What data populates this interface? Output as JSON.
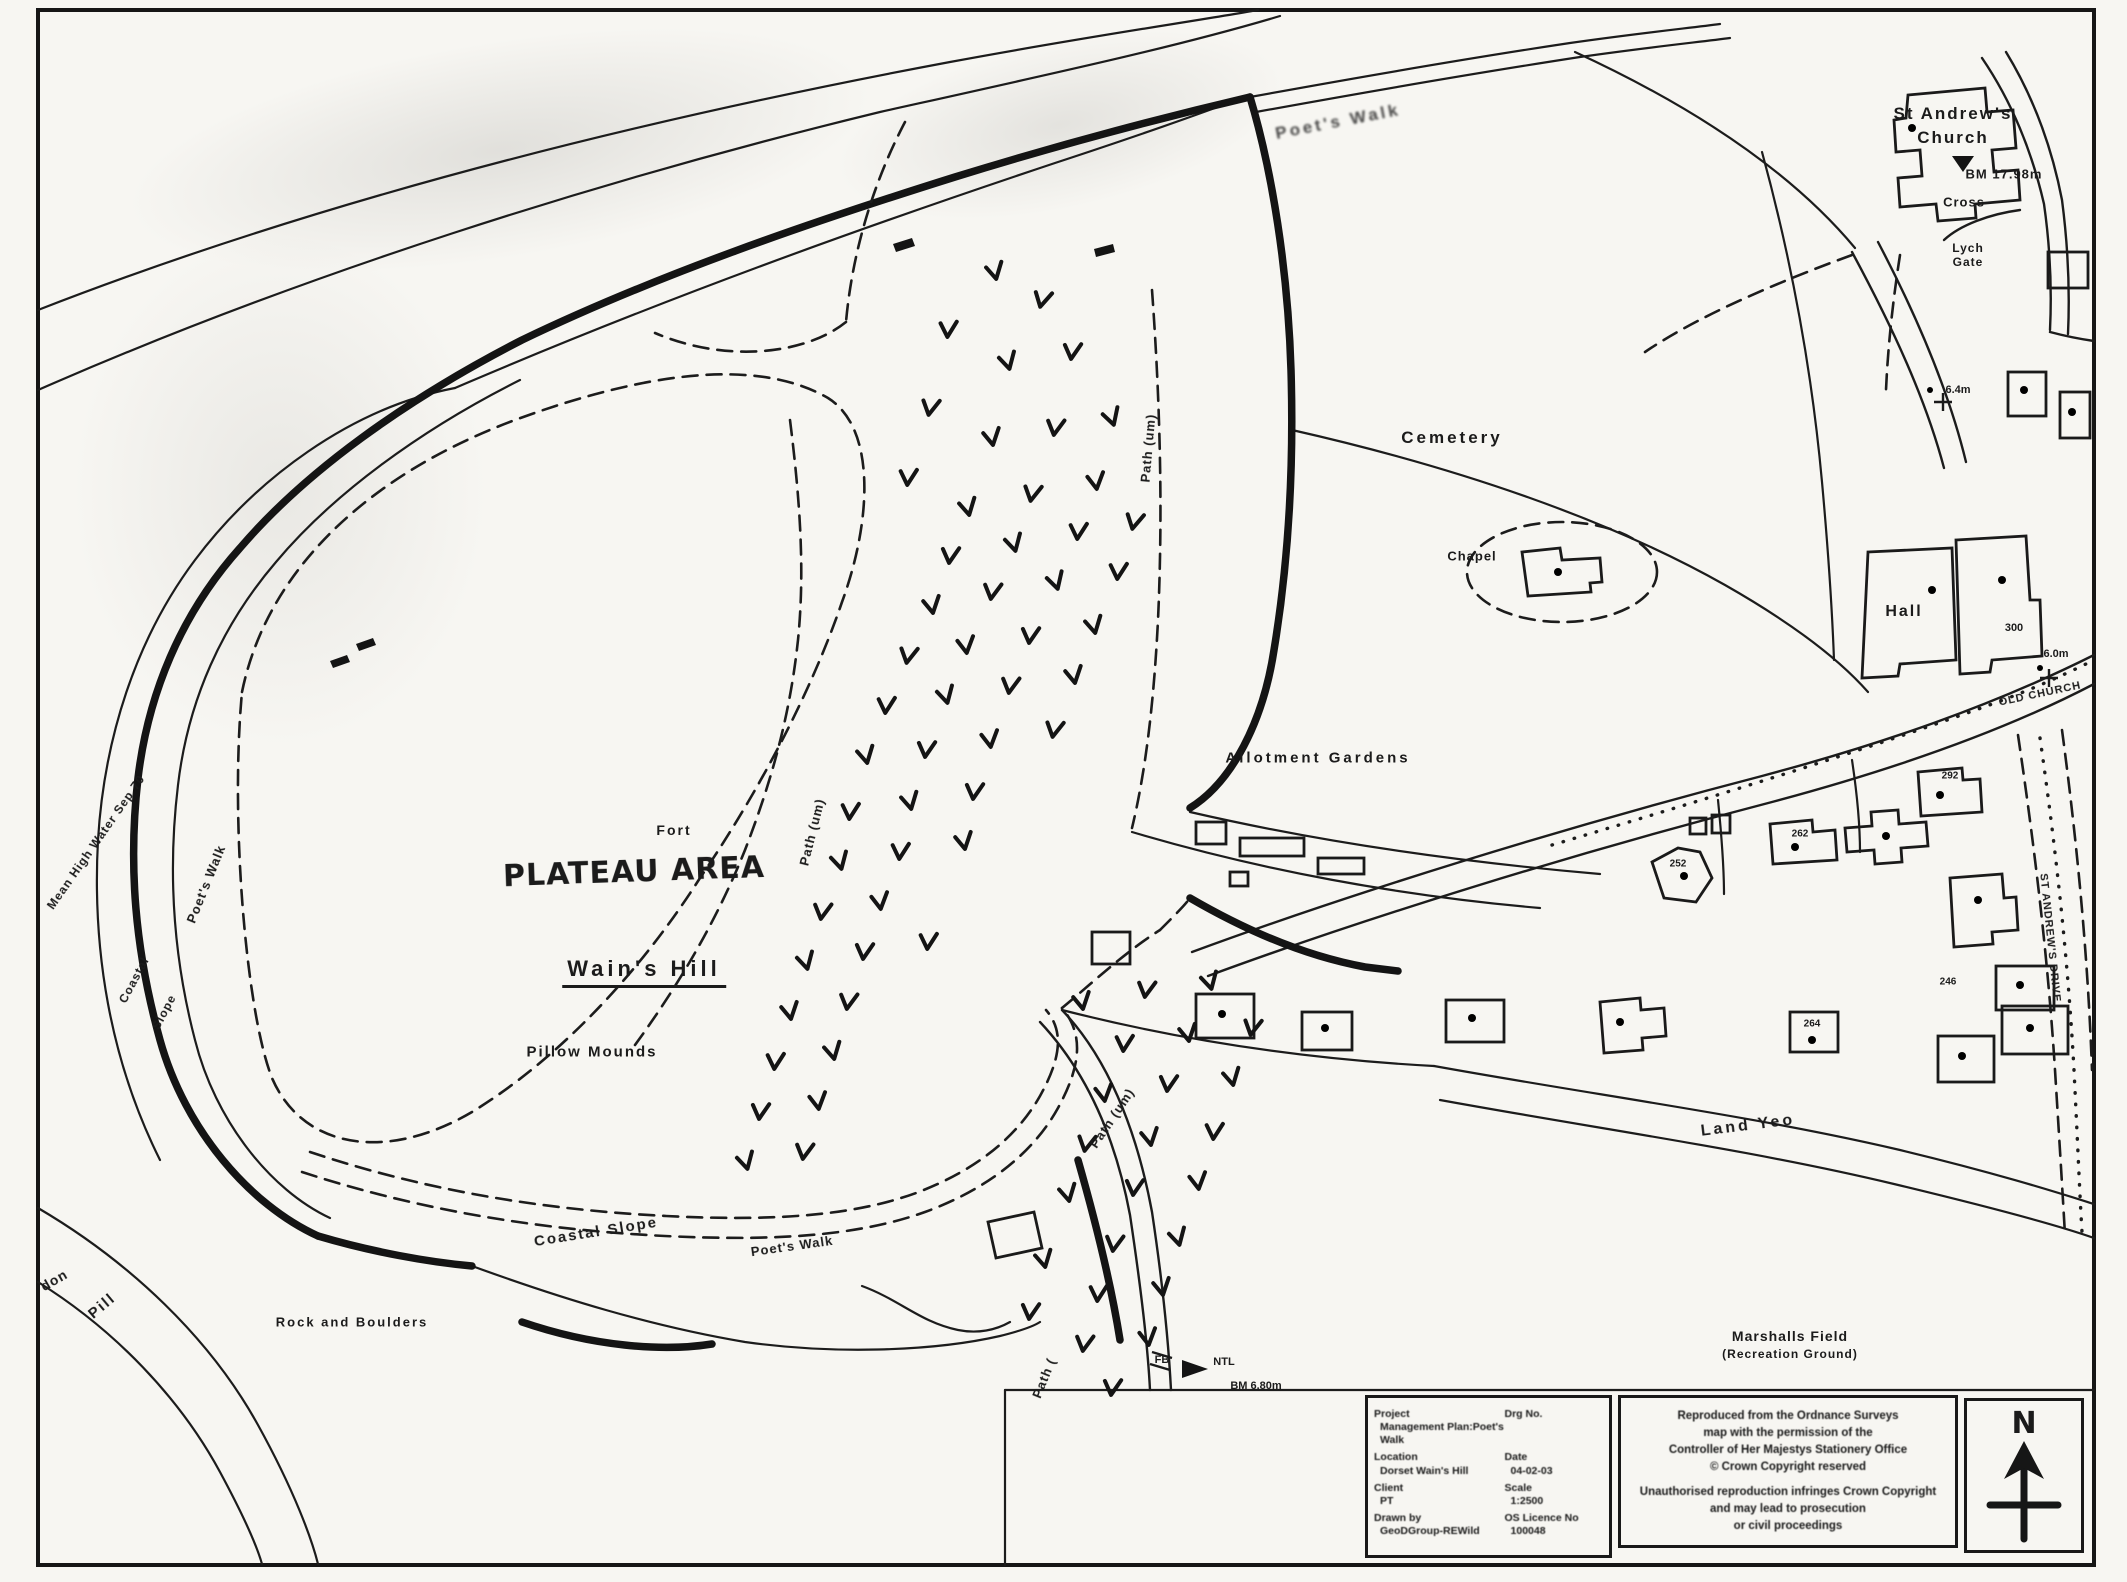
{
  "map": {
    "labels": [
      [
        "Poet's Walk",
        1338,
        122,
        -11,
        17,
        3,
        "s"
      ],
      [
        "St Andrew's",
        1953,
        114,
        0,
        17,
        2,
        "p"
      ],
      [
        "Church",
        1953,
        138,
        0,
        17,
        2,
        "p"
      ],
      [
        "BM 17.98m",
        2004,
        174,
        0,
        13,
        1,
        "p"
      ],
      [
        "Cross",
        1964,
        202,
        0,
        13,
        1,
        "p"
      ],
      [
        "Lych",
        1968,
        248,
        0,
        12,
        1,
        "p"
      ],
      [
        "Gate",
        1968,
        262,
        0,
        12,
        1,
        "p"
      ],
      [
        "Cemetery",
        1452,
        438,
        0,
        17,
        3,
        "p"
      ],
      [
        "Chapel",
        1472,
        556,
        0,
        13,
        1,
        "p"
      ],
      [
        "Hall",
        1904,
        612,
        0,
        16,
        2,
        "p"
      ],
      [
        "300",
        2014,
        628,
        0,
        11,
        0,
        "p"
      ],
      [
        "6.4m",
        1958,
        390,
        0,
        11,
        0,
        "p"
      ],
      [
        "6.0m",
        2056,
        654,
        0,
        11,
        0,
        "p"
      ],
      [
        "OLD CHURCH",
        2040,
        694,
        -12,
        11,
        1,
        "p"
      ],
      [
        "ST ANDREW'S DRIVE",
        2050,
        938,
        84,
        11,
        1,
        "p"
      ],
      [
        "Allotment Gardens",
        1318,
        758,
        0,
        15,
        3,
        "p"
      ],
      [
        "Fort",
        674,
        830,
        0,
        14,
        2,
        "p"
      ],
      [
        "PLATEAU AREA",
        634,
        872,
        -2,
        30,
        1,
        "h"
      ],
      [
        "Wain's Hill",
        644,
        972,
        0,
        22,
        4,
        "u"
      ],
      [
        "Pillow Mounds",
        592,
        1052,
        0,
        15,
        2,
        "p"
      ],
      [
        "Path (um)",
        812,
        832,
        -76,
        13,
        1,
        "p"
      ],
      [
        "Path (um)",
        1148,
        448,
        -85,
        13,
        1,
        "p"
      ],
      [
        "Path (um)",
        1112,
        1118,
        -56,
        13,
        1,
        "p"
      ],
      [
        "Path (",
        1044,
        1378,
        -68,
        13,
        1,
        "p"
      ],
      [
        "Poet's Walk",
        206,
        884,
        -68,
        13,
        1,
        "p"
      ],
      [
        "Mean High Water Sep 70",
        96,
        842,
        -55,
        12,
        1,
        "p"
      ],
      [
        "Coastal",
        134,
        980,
        -62,
        12,
        1,
        "p"
      ],
      [
        "Slope",
        164,
        1012,
        -62,
        12,
        1,
        "p"
      ],
      [
        "Coastal Slope",
        596,
        1232,
        -9,
        15,
        2,
        "p"
      ],
      [
        "Poet's Walk",
        792,
        1246,
        -8,
        13,
        1,
        "p"
      ],
      [
        "Rock and Boulders",
        352,
        1322,
        0,
        13,
        2,
        "p"
      ],
      [
        "don",
        54,
        1280,
        -30,
        14,
        1,
        "p"
      ],
      [
        "Pill",
        102,
        1306,
        -40,
        15,
        2,
        "p"
      ],
      [
        "Land Yeo",
        1748,
        1126,
        -7,
        16,
        3,
        "p"
      ],
      [
        "Marshalls Field",
        1790,
        1336,
        0,
        14,
        1,
        "p"
      ],
      [
        "(Recreation Ground)",
        1790,
        1354,
        0,
        12,
        1,
        "p"
      ],
      [
        "FB",
        1162,
        1360,
        0,
        11,
        0,
        "p"
      ],
      [
        "NTL",
        1224,
        1362,
        0,
        11,
        0,
        "p"
      ],
      [
        "BM 6.80m",
        1256,
        1386,
        0,
        11,
        0,
        "p"
      ],
      [
        "292",
        1950,
        776,
        0,
        10,
        0,
        "p"
      ],
      [
        "262",
        1800,
        834,
        0,
        10,
        0,
        "p"
      ],
      [
        "252",
        1678,
        864,
        0,
        10,
        0,
        "p"
      ],
      [
        "264",
        1812,
        1024,
        0,
        10,
        0,
        "p"
      ],
      [
        "246",
        1948,
        982,
        0,
        10,
        0,
        "p"
      ]
    ],
    "scrub_marks": [
      [
        995,
        272,
        -10
      ],
      [
        1042,
        300,
        15
      ],
      [
        948,
        330,
        5
      ],
      [
        1008,
        362,
        -12
      ],
      [
        1072,
        352,
        8
      ],
      [
        930,
        408,
        12
      ],
      [
        992,
        438,
        -8
      ],
      [
        1055,
        428,
        10
      ],
      [
        1112,
        418,
        -15
      ],
      [
        908,
        478,
        6
      ],
      [
        968,
        508,
        -10
      ],
      [
        1032,
        494,
        12
      ],
      [
        1096,
        482,
        -6
      ],
      [
        950,
        556,
        8
      ],
      [
        1014,
        544,
        -12
      ],
      [
        1078,
        532,
        6
      ],
      [
        1134,
        522,
        14
      ],
      [
        932,
        606,
        -8
      ],
      [
        992,
        592,
        10
      ],
      [
        1056,
        582,
        -14
      ],
      [
        1118,
        572,
        6
      ],
      [
        908,
        656,
        12
      ],
      [
        966,
        646,
        -6
      ],
      [
        1030,
        636,
        8
      ],
      [
        1094,
        626,
        -10
      ],
      [
        886,
        706,
        6
      ],
      [
        946,
        696,
        -12
      ],
      [
        1010,
        686,
        10
      ],
      [
        1074,
        676,
        -8
      ],
      [
        866,
        756,
        -10
      ],
      [
        926,
        750,
        8
      ],
      [
        990,
        740,
        -6
      ],
      [
        1054,
        730,
        12
      ],
      [
        850,
        812,
        6
      ],
      [
        910,
        802,
        -10
      ],
      [
        974,
        792,
        8
      ],
      [
        840,
        862,
        -12
      ],
      [
        900,
        852,
        6
      ],
      [
        964,
        842,
        -8
      ],
      [
        822,
        912,
        10
      ],
      [
        880,
        902,
        -6
      ],
      [
        806,
        962,
        -12
      ],
      [
        864,
        952,
        8
      ],
      [
        928,
        942,
        6
      ],
      [
        790,
        1012,
        -8
      ],
      [
        848,
        1002,
        10
      ],
      [
        775,
        1062,
        6
      ],
      [
        833,
        1052,
        -10
      ],
      [
        760,
        1112,
        8
      ],
      [
        818,
        1102,
        -6
      ],
      [
        746,
        1162,
        -12
      ],
      [
        804,
        1152,
        10
      ],
      [
        1082,
        1002,
        -8
      ],
      [
        1146,
        990,
        10
      ],
      [
        1210,
        982,
        -12
      ],
      [
        1124,
        1044,
        6
      ],
      [
        1188,
        1034,
        -8
      ],
      [
        1252,
        1028,
        12
      ],
      [
        1104,
        1094,
        -6
      ],
      [
        1168,
        1084,
        8
      ],
      [
        1232,
        1078,
        -10
      ],
      [
        1086,
        1144,
        12
      ],
      [
        1150,
        1138,
        -8
      ],
      [
        1214,
        1132,
        6
      ],
      [
        1068,
        1194,
        -10
      ],
      [
        1134,
        1188,
        8
      ],
      [
        1198,
        1182,
        -6
      ],
      [
        1114,
        1244,
        10
      ],
      [
        1178,
        1238,
        -12
      ],
      [
        1098,
        1294,
        6
      ],
      [
        1162,
        1288,
        -8
      ],
      [
        1084,
        1344,
        10
      ],
      [
        1148,
        1338,
        -6
      ],
      [
        1112,
        1388,
        8
      ],
      [
        1044,
        1260,
        -10
      ],
      [
        1030,
        1312,
        8
      ]
    ]
  },
  "title_block": {
    "project_label": "Project",
    "project_value": "Management Plan:Poet's Walk",
    "drg_label": "Drg No.",
    "drg_value": "",
    "location_label": "Location",
    "location_value": "Dorset Wain's Hill",
    "date_label": "Date",
    "date_value": "04-02-03",
    "client_label": "Client",
    "client_value": "PT",
    "scale_label": "Scale",
    "scale_value": "1:2500",
    "drawn_label": "Drawn by",
    "drawn_value": "GeoDGroup-REWild",
    "licence_label": "OS Licence No",
    "licence_value": "100048"
  },
  "copyright": {
    "lines": [
      "Reproduced from the Ordnance Surveys",
      "map with the permission of the",
      "Controller of Her Majestys Stationery Office",
      "© Crown Copyright reserved",
      "Unauthorised reproduction infringes Crown Copyright",
      "and may lead to prosecution",
      "or civil proceedings"
    ]
  },
  "north": {
    "label": "N"
  }
}
